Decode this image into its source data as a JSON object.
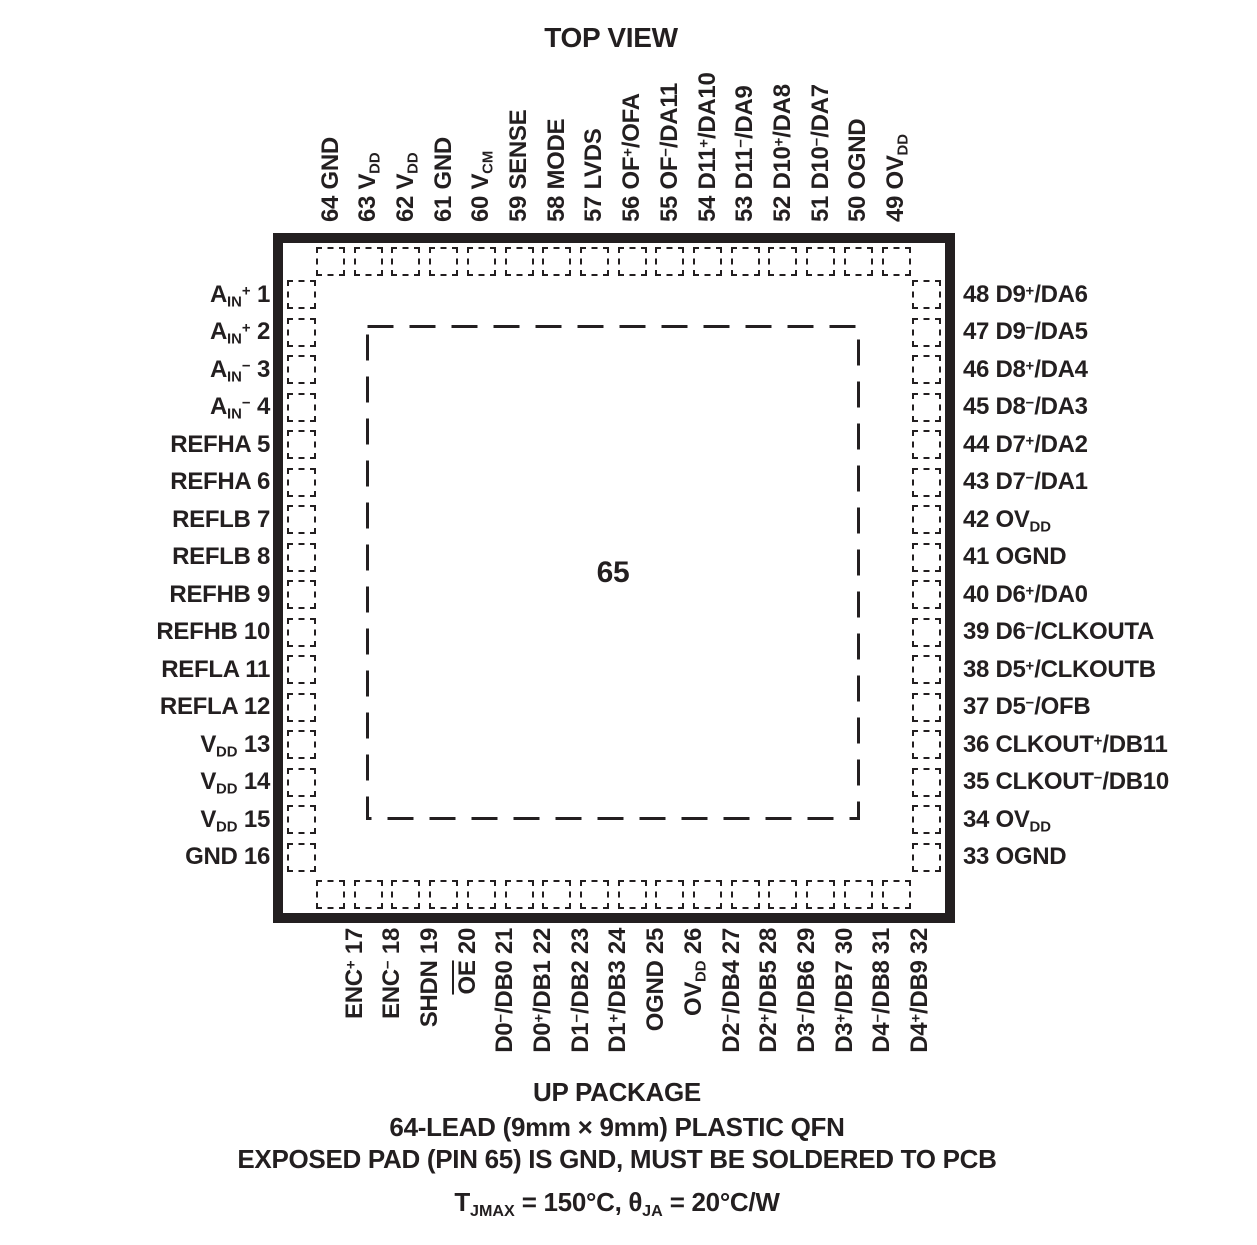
{
  "title": "TOP VIEW",
  "package": {
    "exposed_pad_number": "65"
  },
  "pins": {
    "top": [
      {
        "num": "64",
        "name": "GND"
      },
      {
        "num": "63",
        "name": "V_{DD}"
      },
      {
        "num": "62",
        "name": "V_{DD}"
      },
      {
        "num": "61",
        "name": "GND"
      },
      {
        "num": "60",
        "name": "V_{CM}"
      },
      {
        "num": "59",
        "name": "SENSE"
      },
      {
        "num": "58",
        "name": "MODE"
      },
      {
        "num": "57",
        "name": "LVDS"
      },
      {
        "num": "56",
        "name": "OF^{+}/OFA"
      },
      {
        "num": "55",
        "name": "OF^{−}/DA11"
      },
      {
        "num": "54",
        "name": "D11^{+}/DA10"
      },
      {
        "num": "53",
        "name": "D11^{−}/DA9"
      },
      {
        "num": "52",
        "name": "D10^{+}/DA8"
      },
      {
        "num": "51",
        "name": "D10^{−}/DA7"
      },
      {
        "num": "50",
        "name": "OGND"
      },
      {
        "num": "49",
        "name": "OV_{DD}"
      }
    ],
    "left": [
      {
        "num": "1",
        "name": "A_{IN}^{+}"
      },
      {
        "num": "2",
        "name": "A_{IN}^{+}"
      },
      {
        "num": "3",
        "name": "A_{IN}^{−}"
      },
      {
        "num": "4",
        "name": "A_{IN}^{−}"
      },
      {
        "num": "5",
        "name": "REFHA"
      },
      {
        "num": "6",
        "name": "REFHA"
      },
      {
        "num": "7",
        "name": "REFLB"
      },
      {
        "num": "8",
        "name": "REFLB"
      },
      {
        "num": "9",
        "name": "REFHB"
      },
      {
        "num": "10",
        "name": "REFHB"
      },
      {
        "num": "11",
        "name": "REFLA"
      },
      {
        "num": "12",
        "name": "REFLA"
      },
      {
        "num": "13",
        "name": "V_{DD}"
      },
      {
        "num": "14",
        "name": "V_{DD}"
      },
      {
        "num": "15",
        "name": "V_{DD}"
      },
      {
        "num": "16",
        "name": "GND"
      }
    ],
    "right": [
      {
        "num": "48",
        "name": "D9^{+}/DA6"
      },
      {
        "num": "47",
        "name": "D9^{−}/DA5"
      },
      {
        "num": "46",
        "name": "D8^{+}/DA4"
      },
      {
        "num": "45",
        "name": "D8^{−}/DA3"
      },
      {
        "num": "44",
        "name": "D7^{+}/DA2"
      },
      {
        "num": "43",
        "name": "D7^{−}/DA1"
      },
      {
        "num": "42",
        "name": "OV_{DD}"
      },
      {
        "num": "41",
        "name": "OGND"
      },
      {
        "num": "40",
        "name": "D6^{+}/DA0"
      },
      {
        "num": "39",
        "name": "D6^{−}/CLKOUTA"
      },
      {
        "num": "38",
        "name": "D5^{+}/CLKOUTB"
      },
      {
        "num": "37",
        "name": "D5^{−}/OFB"
      },
      {
        "num": "36",
        "name": "CLKOUT^{+}/DB11"
      },
      {
        "num": "35",
        "name": "CLKOUT^{−}/DB10"
      },
      {
        "num": "34",
        "name": "OV_{DD}"
      },
      {
        "num": "33",
        "name": "OGND"
      }
    ],
    "bottom": [
      {
        "num": "17",
        "name": "ENC^{+}"
      },
      {
        "num": "18",
        "name": "ENC^{−}"
      },
      {
        "num": "19",
        "name": "SHDN"
      },
      {
        "num": "20",
        "name": "~{OE}"
      },
      {
        "num": "21",
        "name": "D0^{−}/DB0"
      },
      {
        "num": "22",
        "name": "D0^{+}/DB1"
      },
      {
        "num": "23",
        "name": "D1^{−}/DB2"
      },
      {
        "num": "24",
        "name": "D1^{+}/DB3"
      },
      {
        "num": "25",
        "name": "OGND"
      },
      {
        "num": "26",
        "name": "OV_{DD}"
      },
      {
        "num": "27",
        "name": "D2^{−}/DB4"
      },
      {
        "num": "28",
        "name": "D2^{+}/DB5"
      },
      {
        "num": "29",
        "name": "D3^{−}/DB6"
      },
      {
        "num": "30",
        "name": "D3^{+}/DB7"
      },
      {
        "num": "31",
        "name": "D4^{−}/DB8"
      },
      {
        "num": "32",
        "name": "D4^{+}/DB9"
      }
    ]
  },
  "footer": {
    "line1": "UP PACKAGE",
    "line2": "64-LEAD (9mm × 9mm) PLASTIC QFN",
    "line3": "EXPOSED PAD (PIN 65) IS GND, MUST BE SOLDERED TO PCB",
    "line4": "T_{JMAX} = 150°C, θ_{JA} = 20°C/W"
  },
  "colors": {
    "ink": "#231f20",
    "background": "#ffffff"
  }
}
